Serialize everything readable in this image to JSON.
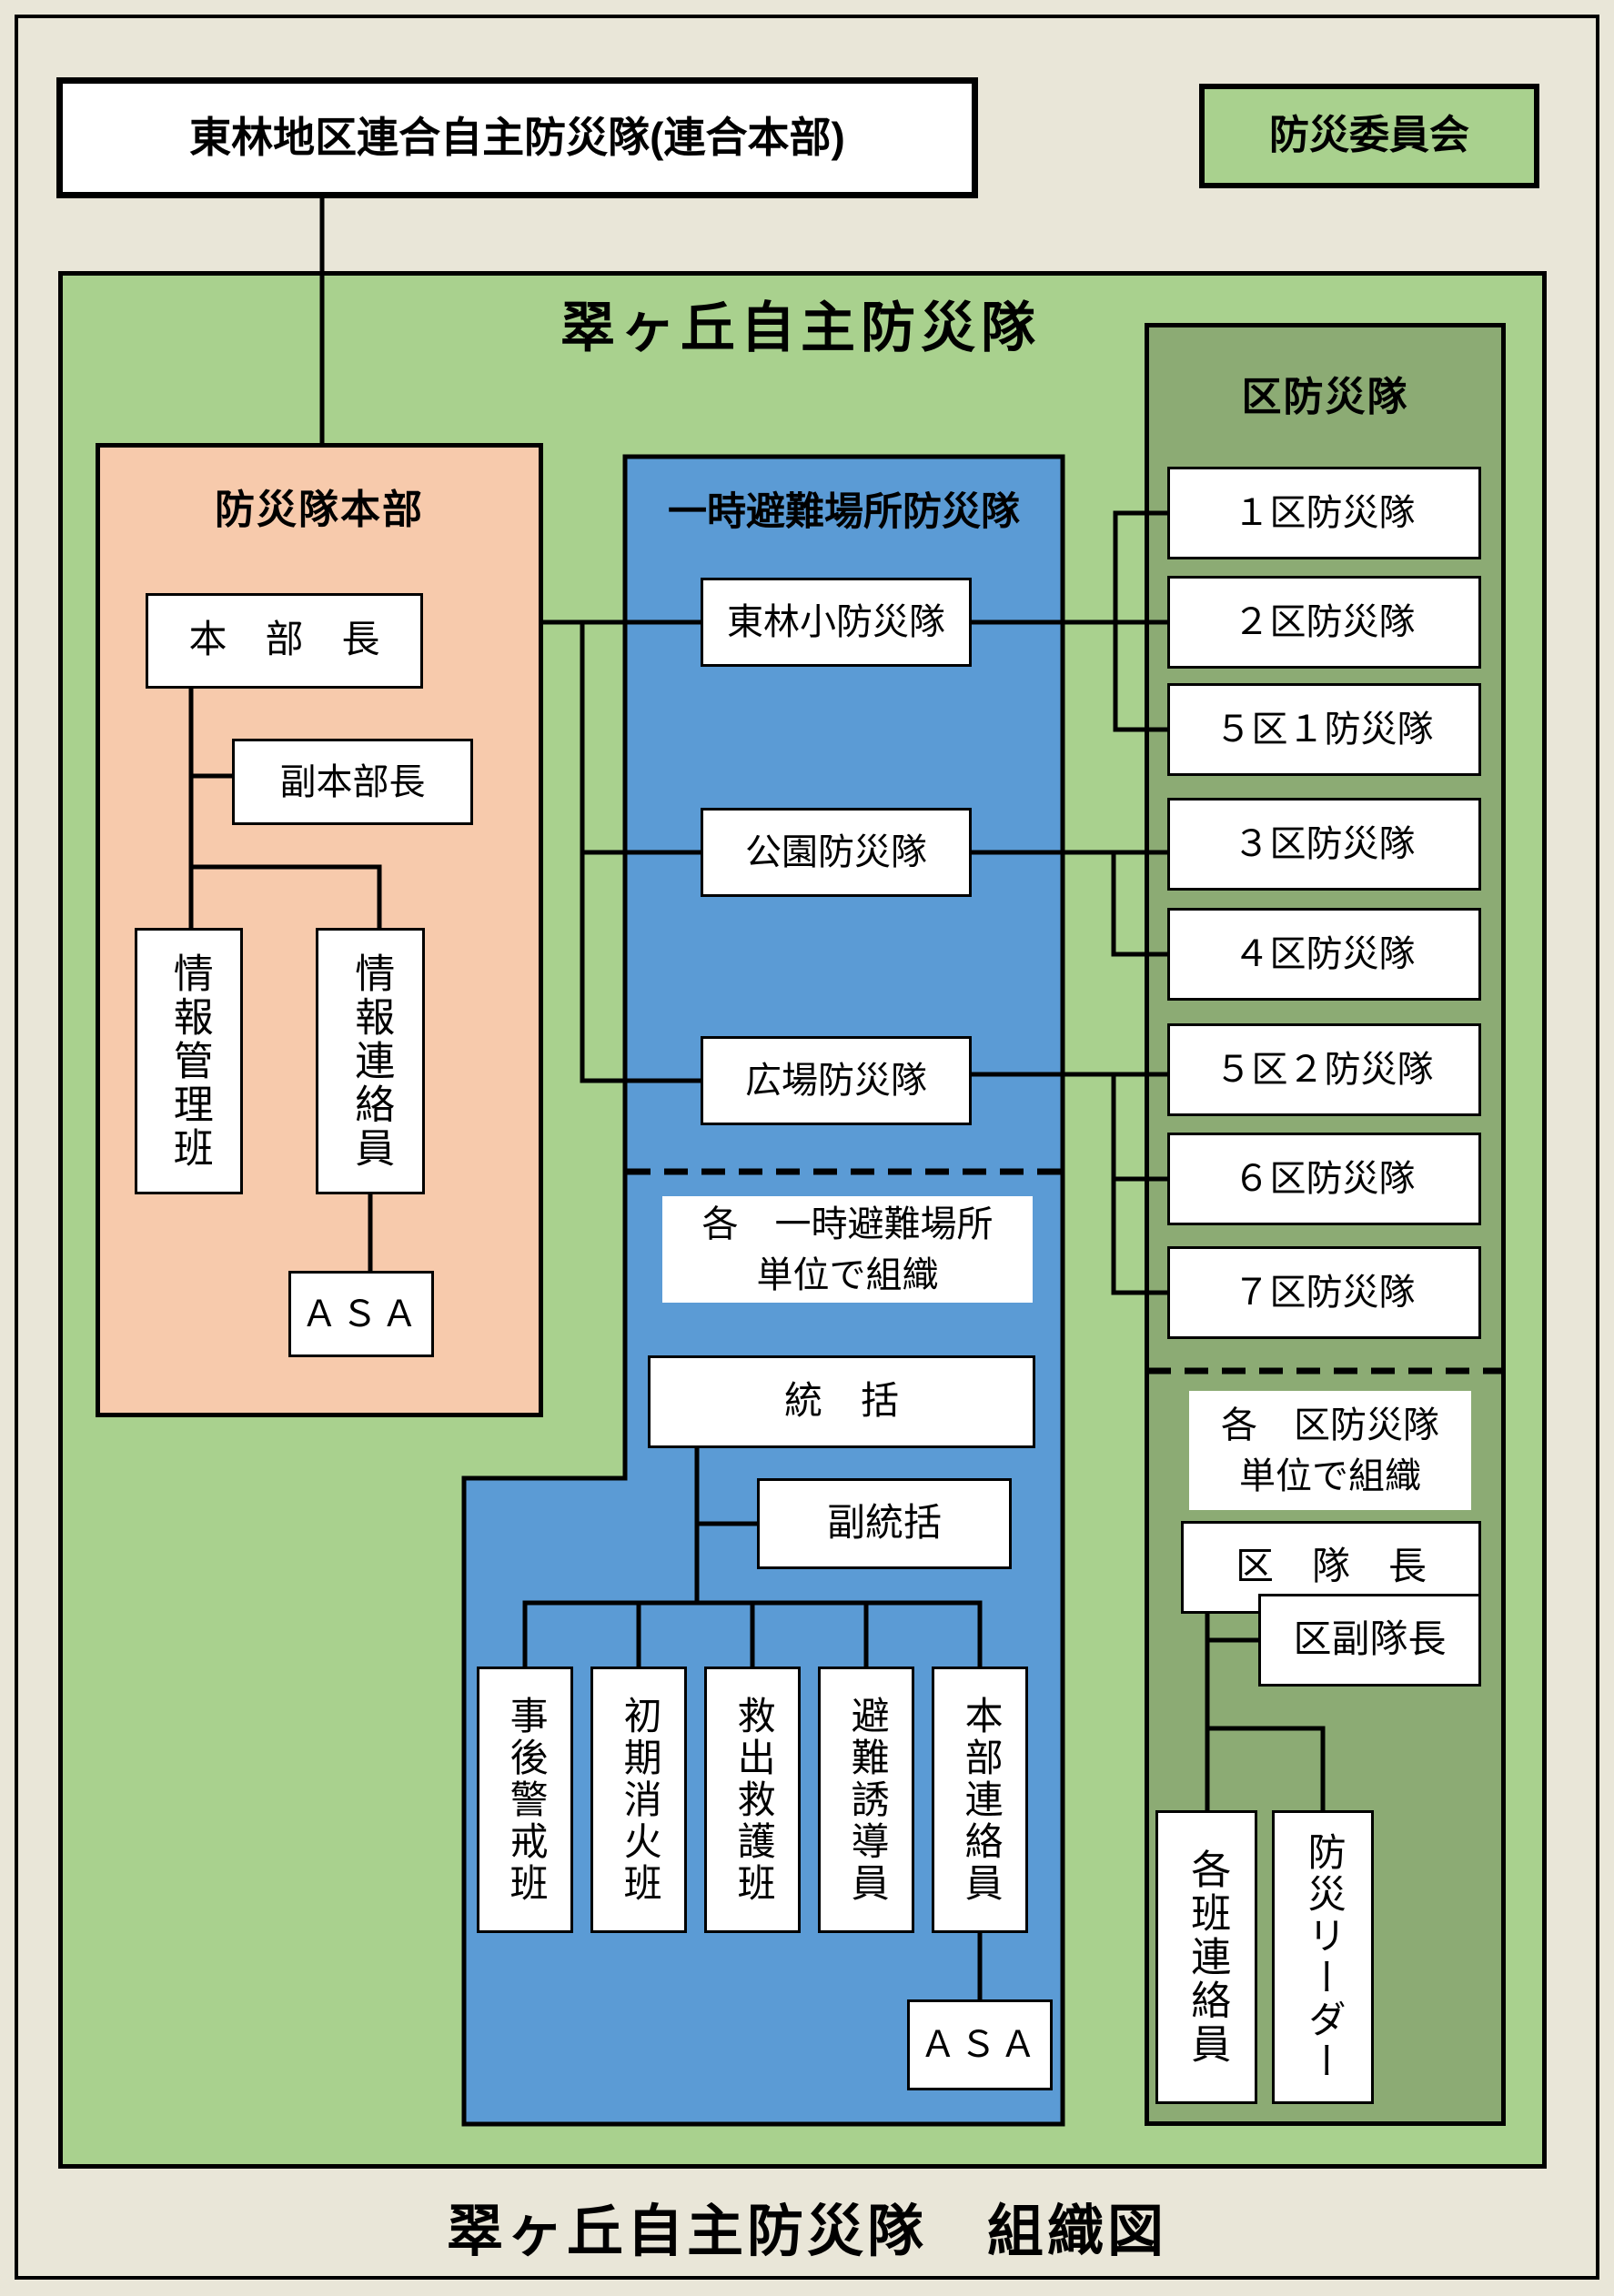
{
  "colors": {
    "page_bg": "#e9e6d8",
    "light_green": "#a9d18e",
    "panel_green": "#8cab74",
    "blue": "#5b9bd5",
    "pink": "#f7caac",
    "line": "#000000"
  },
  "header": {
    "union_hq_box": "東林地区連合自主防災隊(連合本部)",
    "committee_box": "防災委員会"
  },
  "main_area": {
    "title": "翠ヶ丘自主防災隊",
    "bottom_caption": "翠ヶ丘自主防災隊　組織図"
  },
  "hq": {
    "title": "防災隊本部",
    "chief": "本　部　長",
    "deputy_chief": "副本部長",
    "info_management": "情報管理班",
    "info_liaison": "情報連絡員",
    "asa": "ＡＳＡ"
  },
  "shelter": {
    "title": "一時避難場所防災隊",
    "units": [
      "東林小防災隊",
      "公園防災隊",
      "広場防災隊"
    ],
    "note_line1": "各　一時避難場所",
    "note_line2": "単位で組織",
    "leader": "統　括",
    "deputy_leader": "副統括",
    "teams": [
      "事後警戒班",
      "初期消火班",
      "救出救護班",
      "避難誘導員",
      "本部連絡員"
    ],
    "asa": "ＡＳＡ"
  },
  "districts": {
    "title": "区防災隊",
    "units": [
      "１区防災隊",
      "２区防災隊",
      "５区１防災隊",
      "３区防災隊",
      "４区防災隊",
      "５区２防災隊",
      "６区防災隊",
      "７区防災隊"
    ],
    "note_line1": "各　区防災隊",
    "note_line2": "単位で組織",
    "leader": "区　隊　長",
    "deputy_leader": "区副隊長",
    "group_liaison": "各班連絡員",
    "bousai_leader": "防災リーダー"
  }
}
